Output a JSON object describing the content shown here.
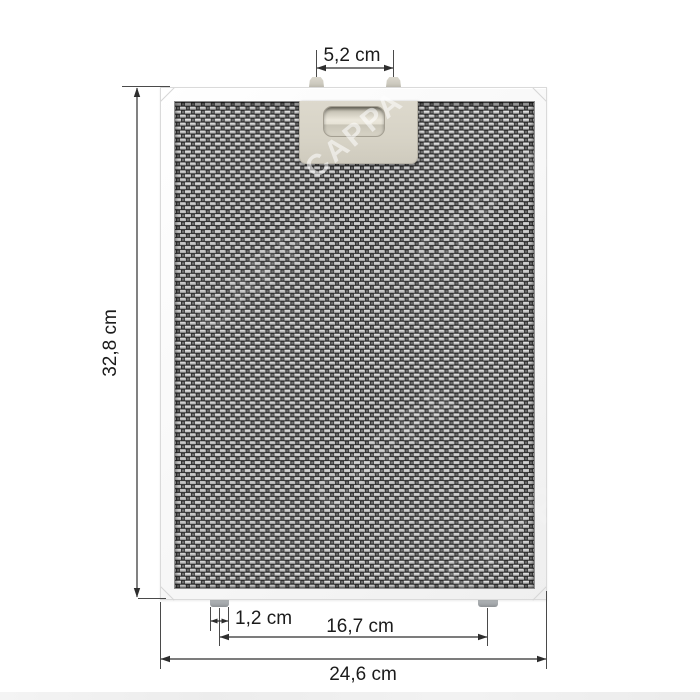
{
  "page": {
    "background_color": "#ffffff",
    "watermark_text": "CAPPA",
    "description": "Dimension diagram of a metal mesh cooker hood grease filter"
  },
  "filter": {
    "frame_color": "#f5f5f5",
    "mesh_dark": "#2d2d2d",
    "mesh_light": "#c6c6c6",
    "mesh_mid": "#757575",
    "handle_color": "#d8d4c7",
    "top_clip_color": "#d2cfc5",
    "bottom_peg_color": "#a3a7aa"
  },
  "annotations": {
    "line_color": "#2e2e2e",
    "text_color": "#1b1b1b",
    "top_clip_spacing": {
      "label": "5,2 cm"
    },
    "height": {
      "label": "32,8 cm"
    },
    "peg_width": {
      "label": "1,2 cm"
    },
    "peg_spacing": {
      "label": "16,7 cm"
    },
    "width": {
      "label": "24,6 cm"
    }
  }
}
